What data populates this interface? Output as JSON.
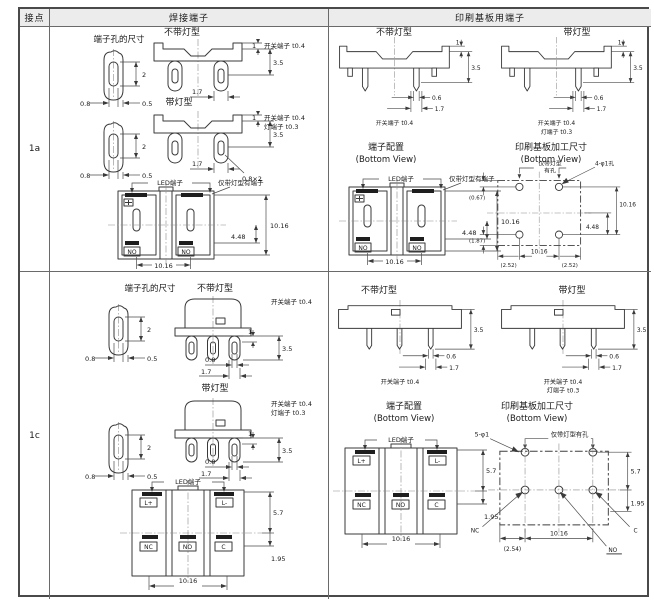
{
  "header": {
    "contact": "接点",
    "solder": "焊接端子",
    "pcb": "印刷基板用端子"
  },
  "rows": {
    "a": "1a",
    "c": "1c"
  },
  "titles": {
    "no_lamp": "不带灯型",
    "lamp": "带灯型",
    "hole_size": "端子孔的尺寸",
    "layout": "端子配置",
    "pcb_dims": "印刷基板加工尺寸",
    "bottom_view": "(Bottom View)"
  },
  "notes": {
    "switch_t": "开关端子 t0.4",
    "lamp_t": "灯端子 t0.3",
    "led": "LED端子",
    "lamp_only_term": "仅带灯型有端子",
    "lamp_only_l1": "仅带灯型",
    "lamp_only_l2": "有孔",
    "lamp_only_holes": "仅带灯型有孔",
    "holes4": "4-φ1孔",
    "holes5": "5-φ1"
  },
  "pins": {
    "no": "NO",
    "nc": "NC",
    "c": "C",
    "lp": "L+",
    "lm": "L-"
  },
  "dims": {
    "d1": "1",
    "d2": "2",
    "d05": "0.5",
    "d06": "0.6",
    "d08": "0.8",
    "d17": "1.7",
    "d35": "3.5",
    "d082": "0.8×2",
    "d1016": "10.16",
    "d448": "4.48",
    "d57": "5.7",
    "d195": "1.95",
    "p067": "(0.67)",
    "p187": "(1.87)",
    "p252": "(2.52)",
    "p254": "(2.54)"
  }
}
